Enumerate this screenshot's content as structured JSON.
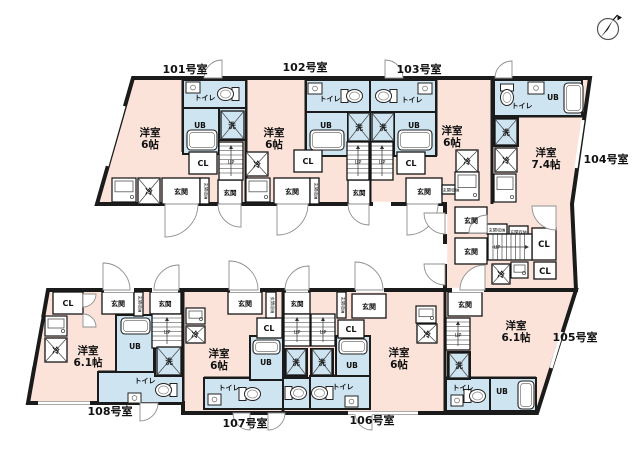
{
  "document_type": "apartment-floor-plan",
  "labels": {
    "toilet": "トイレ",
    "unit_bath": "UB",
    "laundry": "洗",
    "closet": "CL",
    "entrance": "玄関",
    "entrance_storage": "玄関収納",
    "fridge": "冷",
    "up": "UP"
  },
  "units": [
    {
      "number": "101号室",
      "room": "洋室",
      "size": "6帖"
    },
    {
      "number": "102号室",
      "room": "洋室",
      "size": "6帖"
    },
    {
      "number": "103号室",
      "room": "洋室",
      "size": "6帖"
    },
    {
      "number": "104号室",
      "room": "洋室",
      "size": "7.4帖"
    },
    {
      "number": "105号室",
      "room": "洋室",
      "size": "6.1帖"
    },
    {
      "number": "106号室",
      "room": "洋室",
      "size": "6帖"
    },
    {
      "number": "107号室",
      "room": "洋室",
      "size": "6帖"
    },
    {
      "number": "108号室",
      "room": "洋室",
      "size": "6.1帖"
    }
  ],
  "compass": {
    "direction": "N"
  },
  "colors": {
    "room_pink": "#fbe3da",
    "wet_blue": "#cfe4f1",
    "wall": "#1b1b1b",
    "fixture_stroke": "#2a2a2a",
    "door_arc": "#8f8f8f",
    "background": "#ffffff"
  }
}
